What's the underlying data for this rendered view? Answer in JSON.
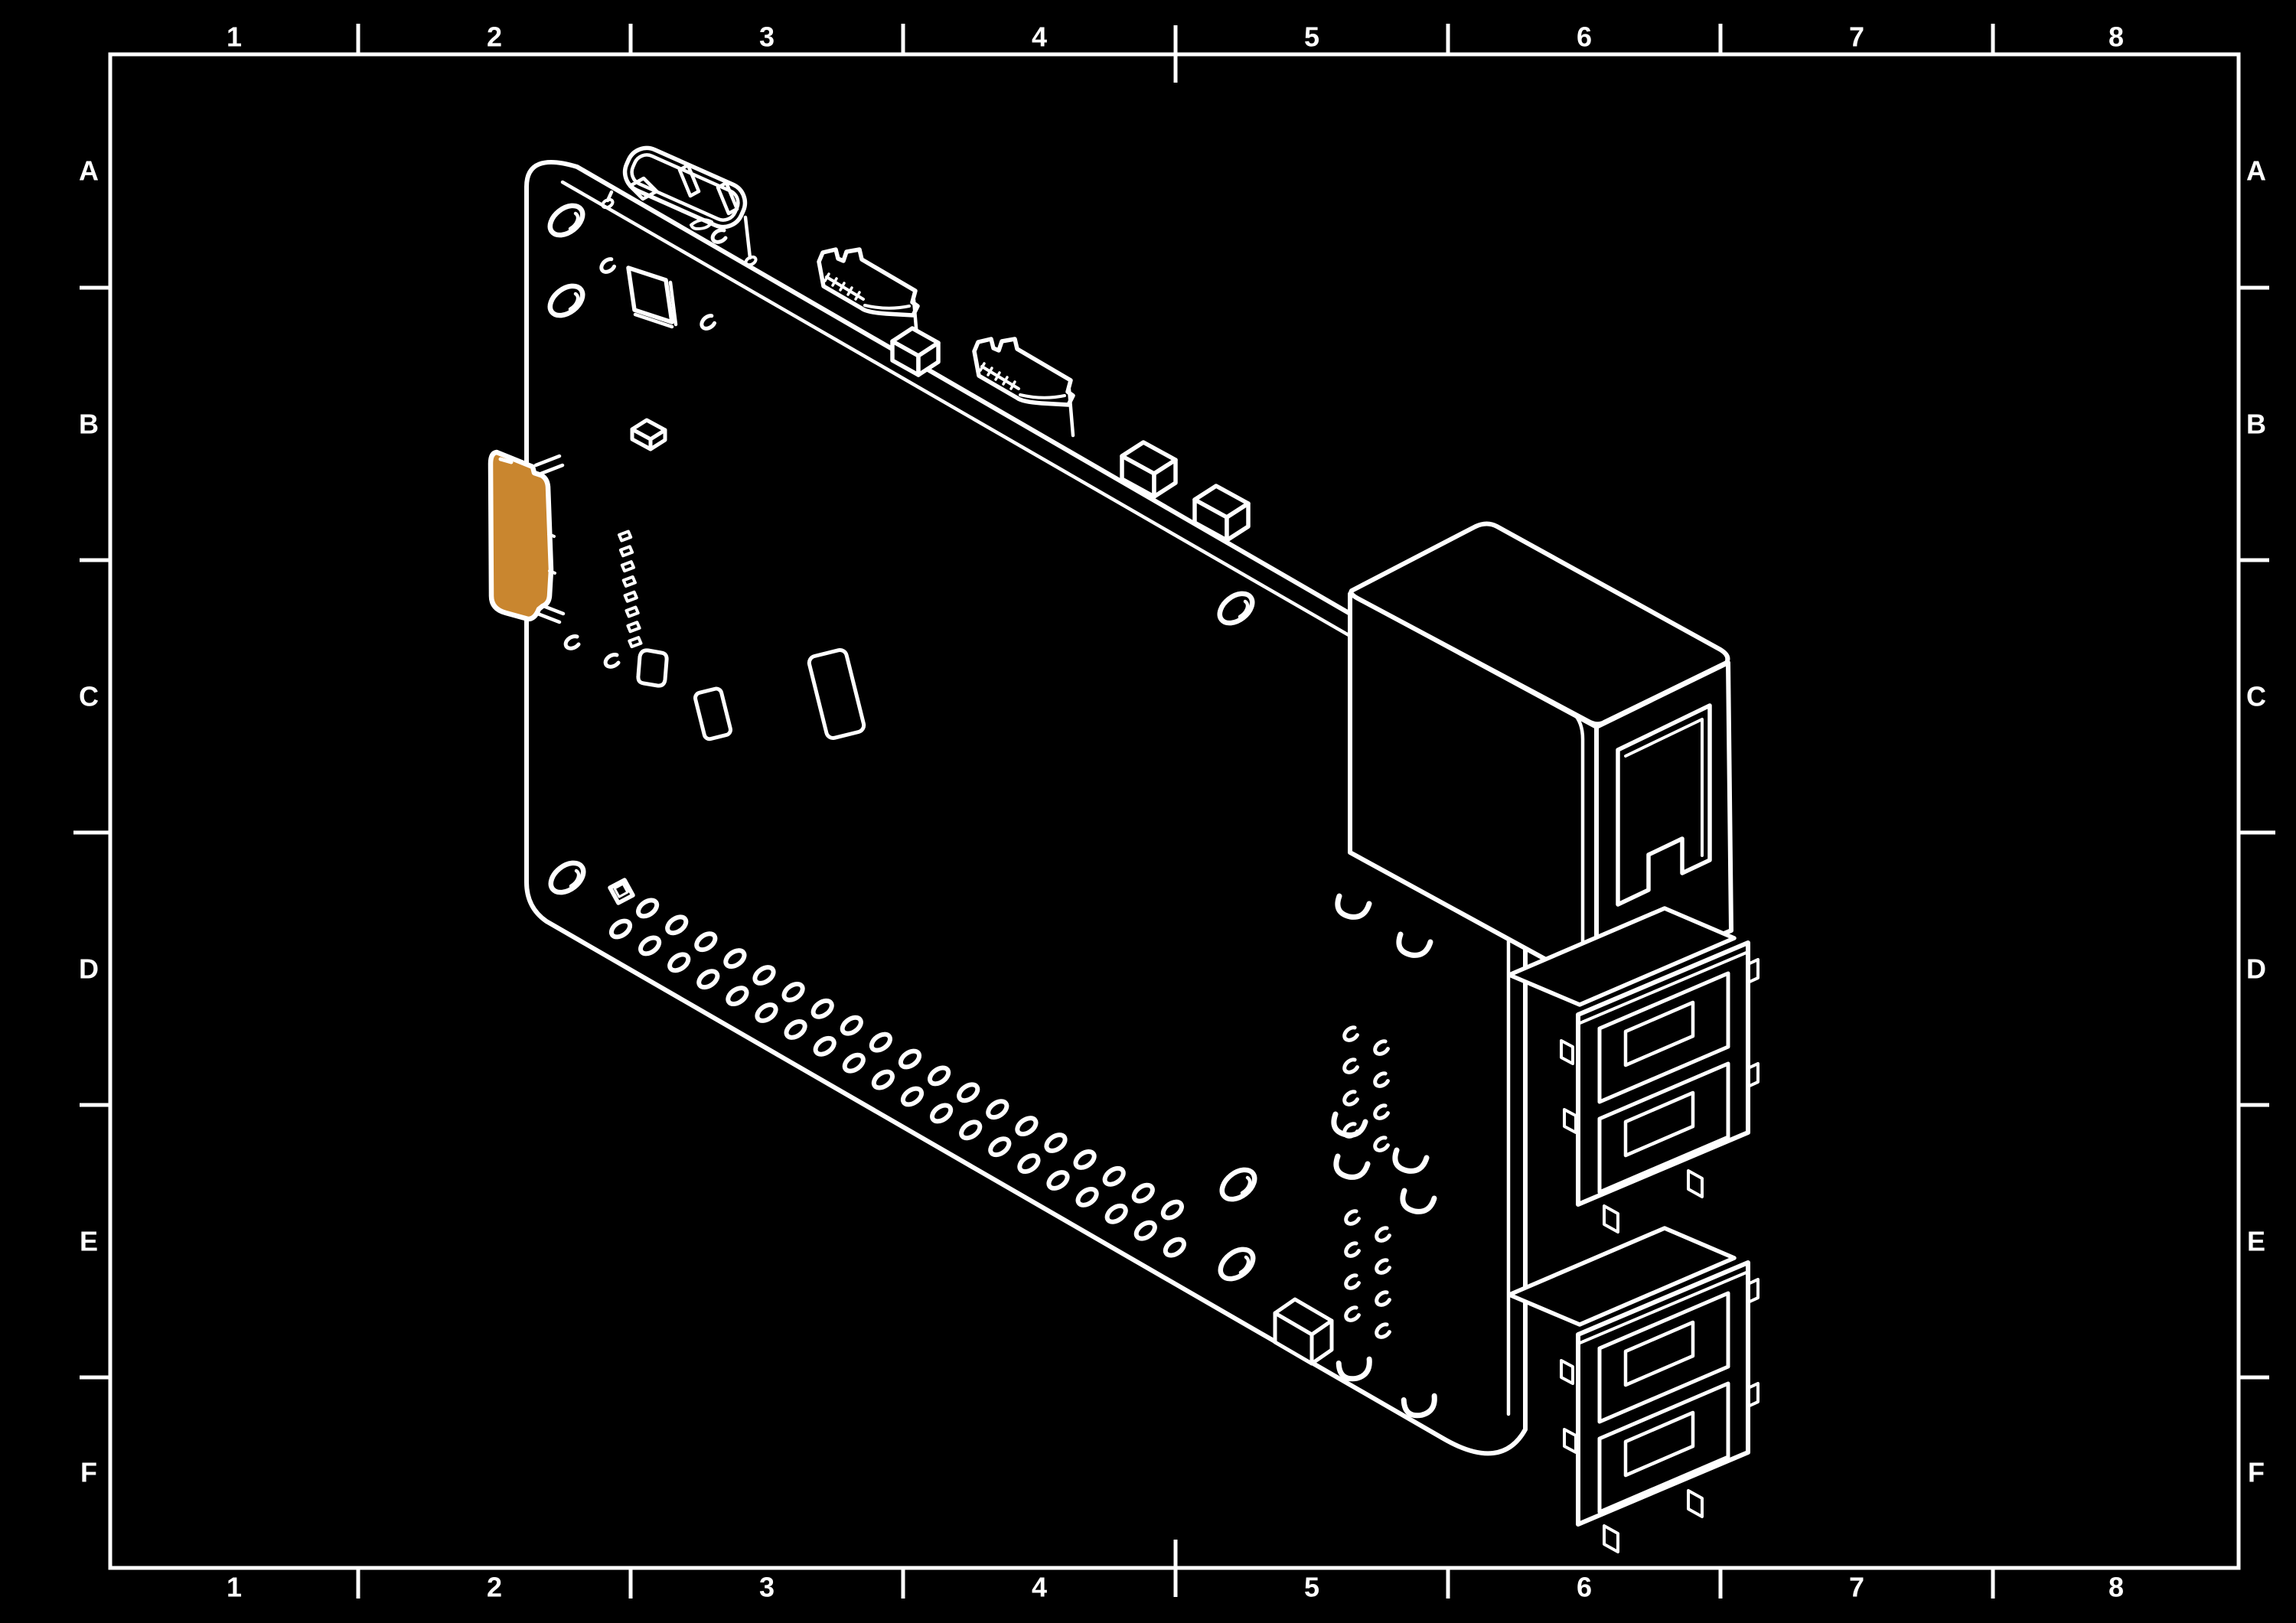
{
  "title": "Isometric line drawing of a single-board computer on a drafting sheet",
  "frame": {
    "columns": [
      "1",
      "2",
      "3",
      "4",
      "5",
      "6",
      "7",
      "8"
    ],
    "rows": [
      "A",
      "B",
      "C",
      "D",
      "E",
      "F"
    ]
  },
  "colors": {
    "background": "#000000",
    "line": "#ffffff",
    "sd_card_highlight": "#c9862f"
  },
  "board": {
    "name": "single-board-computer",
    "highlighted_part": "sd-card",
    "components": [
      "sd-card",
      "sd-card-socket",
      "mounting-holes",
      "gpio-header-through-holes",
      "composite-video-connector",
      "fpc-connector-1",
      "fpc-connector-2",
      "edge-component-boxes",
      "ethernet-port",
      "usb-port-stack-upper",
      "usb-port-stack-lower",
      "smd-chip",
      "smd-components",
      "solder-pad-clusters",
      "connector-pin-hooks"
    ]
  }
}
